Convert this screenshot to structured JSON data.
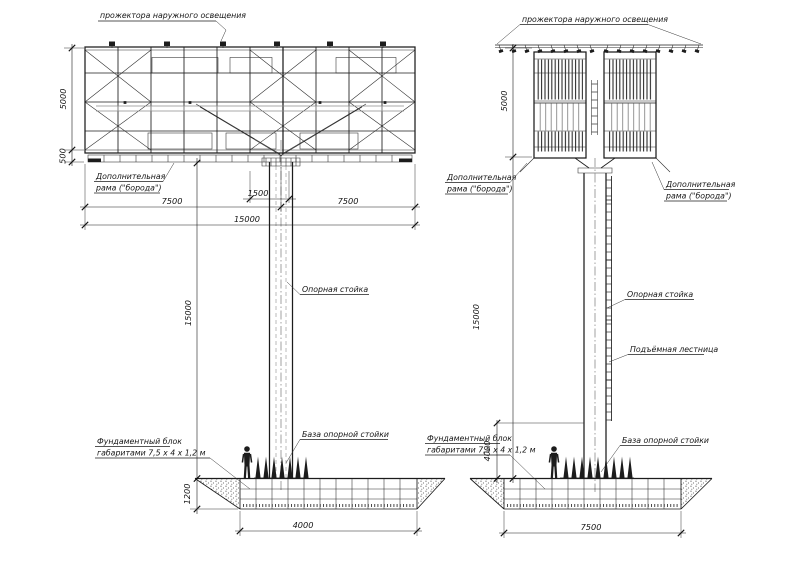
{
  "colors": {
    "background": "#ffffff",
    "line": "#1c1c1c"
  },
  "front": {
    "labels": {
      "floodlights": "прожектора наружного освещения",
      "extra_frame_1": "Дополнительная",
      "extra_frame_2": "рама (\"борода\")",
      "support_column": "Опорная стойка",
      "column_base": "База опорной стойки",
      "foundation_1": "Фундаментный блок",
      "foundation_2": "габаритами  7,5 х 4 х 1,2 м"
    },
    "dims": {
      "panel_height": "5000",
      "extra_frame_height": "500",
      "column_offset": "1500",
      "half_width_left": "7500",
      "half_width_right": "7500",
      "total_width": "15000",
      "column_height": "15000",
      "foundation_depth": "1200",
      "foundation_width": "4000"
    }
  },
  "side": {
    "labels": {
      "floodlights": "прожектора наружного освещения",
      "extra_frame_1": "Дополнительная",
      "extra_frame_2": "рама (\"борода\")",
      "support_column": "Опорная стойка",
      "ladder": "Подъёмная лестница",
      "column_base": "База опорной стойки",
      "foundation_1": "Фундаментный блок",
      "foundation_2": "габаритами  7,5 х 4 х 1,2 м"
    },
    "dims": {
      "panel_height": "5000",
      "column_height": "15000",
      "ladder_clearance": "4000",
      "foundation_length": "7500"
    }
  }
}
